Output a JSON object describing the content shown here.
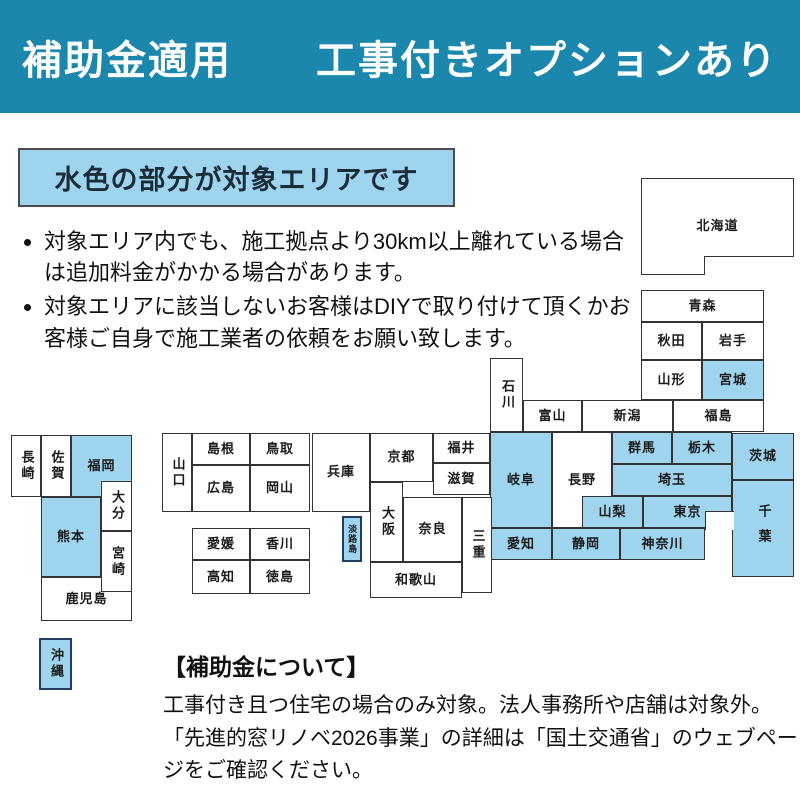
{
  "banner": {
    "title": "補助金適用　　工事付きオプションあり",
    "bg_color": "#1c87ac"
  },
  "legend": {
    "label": "水色の部分が対象エリアです"
  },
  "notes": [
    {
      "text": "対象エリア内でも、施工拠点より30km以上離れている場合は追加料金がかかる場合があります。"
    },
    {
      "text": "対象エリアに該当しないお客様はDIYで取り付けて頂くかお客様ご自身で施工業者の依頼をお願い致します。"
    }
  ],
  "map": {
    "target_area_fill": "#9ed4ee",
    "border_color": "#333333",
    "island_border_color": "#1f3e63",
    "prefectures": [
      {
        "id": "hokkaido",
        "label": "北海道",
        "x": 641,
        "y": 178,
        "w": 153,
        "h": 97,
        "blue": false
      },
      {
        "id": "aomori",
        "label": "青森",
        "x": 641,
        "y": 290,
        "w": 123,
        "h": 32,
        "blue": false
      },
      {
        "id": "akita",
        "label": "秋田",
        "x": 641,
        "y": 322,
        "w": 61,
        "h": 38,
        "blue": false
      },
      {
        "id": "iwate",
        "label": "岩手",
        "x": 702,
        "y": 322,
        "w": 62,
        "h": 38,
        "blue": false
      },
      {
        "id": "yamagata",
        "label": "山形",
        "x": 641,
        "y": 360,
        "w": 61,
        "h": 40,
        "blue": false
      },
      {
        "id": "miyagi",
        "label": "宮城",
        "x": 702,
        "y": 360,
        "w": 62,
        "h": 40,
        "blue": true
      },
      {
        "id": "fukushima",
        "label": "福島",
        "x": 673,
        "y": 400,
        "w": 91,
        "h": 32,
        "blue": false
      },
      {
        "id": "niigata",
        "label": "新潟",
        "x": 582,
        "y": 400,
        "w": 91,
        "h": 32,
        "blue": false
      },
      {
        "id": "toyama",
        "label": "富山",
        "x": 523,
        "y": 400,
        "w": 59,
        "h": 32,
        "blue": false
      },
      {
        "id": "ishikawa",
        "label": "石川",
        "x": 490,
        "y": 358,
        "w": 33,
        "h": 74,
        "blue": false,
        "vertical": true
      },
      {
        "id": "fukui",
        "label": "福井",
        "x": 433,
        "y": 433,
        "w": 57,
        "h": 30,
        "blue": false
      },
      {
        "id": "shiga",
        "label": "滋賀",
        "x": 433,
        "y": 463,
        "w": 57,
        "h": 32,
        "blue": false
      },
      {
        "id": "nagano",
        "label": "長野",
        "x": 552,
        "y": 432,
        "w": 60,
        "h": 96,
        "blue": false
      },
      {
        "id": "gifu",
        "label": "岐阜",
        "x": 490,
        "y": 432,
        "w": 62,
        "h": 96,
        "blue": true
      },
      {
        "id": "gunma",
        "label": "群馬",
        "x": 612,
        "y": 432,
        "w": 60,
        "h": 32,
        "blue": true
      },
      {
        "id": "tochigi",
        "label": "栃木",
        "x": 672,
        "y": 432,
        "w": 60,
        "h": 32,
        "blue": true
      },
      {
        "id": "ibaraki",
        "label": "茨城",
        "x": 732,
        "y": 433,
        "w": 62,
        "h": 47,
        "blue": true
      },
      {
        "id": "saitama",
        "label": "埼玉",
        "x": 612,
        "y": 464,
        "w": 120,
        "h": 32,
        "blue": true
      },
      {
        "id": "yamanashi",
        "label": "山梨",
        "x": 582,
        "y": 496,
        "w": 61,
        "h": 32,
        "blue": true
      },
      {
        "id": "tokyo",
        "label": "東京",
        "x": 643,
        "y": 496,
        "w": 89,
        "h": 32,
        "blue": true
      },
      {
        "id": "chiba",
        "label": "千葉",
        "x": 732,
        "y": 480,
        "w": 62,
        "h": 97,
        "blue": true,
        "vertical": true,
        "gap": true
      },
      {
        "id": "kanagawa",
        "label": "神奈川",
        "x": 620,
        "y": 528,
        "w": 85,
        "h": 32,
        "blue": true
      },
      {
        "id": "shizuoka",
        "label": "静岡",
        "x": 552,
        "y": 528,
        "w": 68,
        "h": 32,
        "blue": true
      },
      {
        "id": "aichi",
        "label": "愛知",
        "x": 490,
        "y": 528,
        "w": 62,
        "h": 32,
        "blue": true
      },
      {
        "id": "mie",
        "label": "三重",
        "x": 462,
        "y": 497,
        "w": 30,
        "h": 96,
        "blue": false,
        "vertical": true
      },
      {
        "id": "kyoto",
        "label": "京都",
        "x": 370,
        "y": 433,
        "w": 63,
        "h": 49,
        "blue": false
      },
      {
        "id": "osaka",
        "label": "大阪",
        "x": 370,
        "y": 482,
        "w": 33,
        "h": 80,
        "blue": false,
        "vertical": true
      },
      {
        "id": "nara",
        "label": "奈良",
        "x": 403,
        "y": 497,
        "w": 59,
        "h": 65,
        "blue": false
      },
      {
        "id": "wakayama",
        "label": "和歌山",
        "x": 370,
        "y": 562,
        "w": 92,
        "h": 36,
        "blue": false
      },
      {
        "id": "hyogo",
        "label": "兵庫",
        "x": 312,
        "y": 433,
        "w": 58,
        "h": 79,
        "blue": false
      },
      {
        "id": "awajishima",
        "label": "淡路島",
        "x": 342,
        "y": 516,
        "w": 20,
        "h": 46,
        "blue": true,
        "vertical": true,
        "small": true,
        "thick": true
      },
      {
        "id": "shimane",
        "label": "島根",
        "x": 192,
        "y": 433,
        "w": 58,
        "h": 32,
        "blue": false
      },
      {
        "id": "tottori",
        "label": "鳥取",
        "x": 250,
        "y": 433,
        "w": 60,
        "h": 32,
        "blue": false
      },
      {
        "id": "hiroshima",
        "label": "広島",
        "x": 192,
        "y": 465,
        "w": 58,
        "h": 47,
        "blue": false
      },
      {
        "id": "okayama",
        "label": "岡山",
        "x": 250,
        "y": 465,
        "w": 60,
        "h": 47,
        "blue": false
      },
      {
        "id": "yamaguchi",
        "label": "山口",
        "x": 162,
        "y": 433,
        "w": 30,
        "h": 79,
        "blue": false,
        "vertical": true
      },
      {
        "id": "ehime",
        "label": "愛媛",
        "x": 192,
        "y": 528,
        "w": 58,
        "h": 32,
        "blue": false
      },
      {
        "id": "kagawa",
        "label": "香川",
        "x": 250,
        "y": 528,
        "w": 60,
        "h": 32,
        "blue": false
      },
      {
        "id": "kochi",
        "label": "高知",
        "x": 192,
        "y": 560,
        "w": 58,
        "h": 34,
        "blue": false
      },
      {
        "id": "tokushima",
        "label": "徳島",
        "x": 250,
        "y": 560,
        "w": 60,
        "h": 34,
        "blue": false
      },
      {
        "id": "nagasaki",
        "label": "長崎",
        "x": 11,
        "y": 435,
        "w": 30,
        "h": 62,
        "blue": false,
        "vertical": true
      },
      {
        "id": "saga",
        "label": "佐賀",
        "x": 41,
        "y": 435,
        "w": 30,
        "h": 62,
        "blue": false,
        "vertical": true
      },
      {
        "id": "fukuoka",
        "label": "福岡",
        "x": 71,
        "y": 435,
        "w": 61,
        "h": 62,
        "blue": true,
        "clip": "polygon(0 0,100% 0,100% 74%,49% 74%,49% 100%,0 100%)"
      },
      {
        "id": "oita",
        "label": "大分",
        "x": 101,
        "y": 481,
        "w": 31,
        "h": 50,
        "blue": false,
        "vertical": true
      },
      {
        "id": "kumamoto",
        "label": "熊本",
        "x": 41,
        "y": 497,
        "w": 60,
        "h": 80,
        "blue": true
      },
      {
        "id": "kagoshima",
        "label": "鹿児島",
        "x": 41,
        "y": 577,
        "w": 91,
        "h": 44,
        "blue": false
      },
      {
        "id": "miyazaki",
        "label": "宮崎",
        "x": 101,
        "y": 531,
        "w": 31,
        "h": 61,
        "blue": false,
        "vertical": true
      },
      {
        "id": "okinawa",
        "label": "沖縄",
        "x": 39,
        "y": 638,
        "w": 33,
        "h": 52,
        "blue": true,
        "vertical": true,
        "thick": true
      }
    ],
    "sea_patches": [
      {
        "id": "hokkaido-notch",
        "x": 704,
        "y": 256,
        "w": 90,
        "h": 19
      },
      {
        "id": "tokyo-bay",
        "x": 705,
        "y": 511,
        "w": 29,
        "h": 19
      }
    ]
  },
  "footer": {
    "title": "【補助金について】",
    "body": "工事付き且つ住宅の場合のみ対象。法人事務所や店舗は対象外。「先進的窓リノベ2026事業」の詳細は「国土交通省」のウェブページをご確認ください。"
  }
}
